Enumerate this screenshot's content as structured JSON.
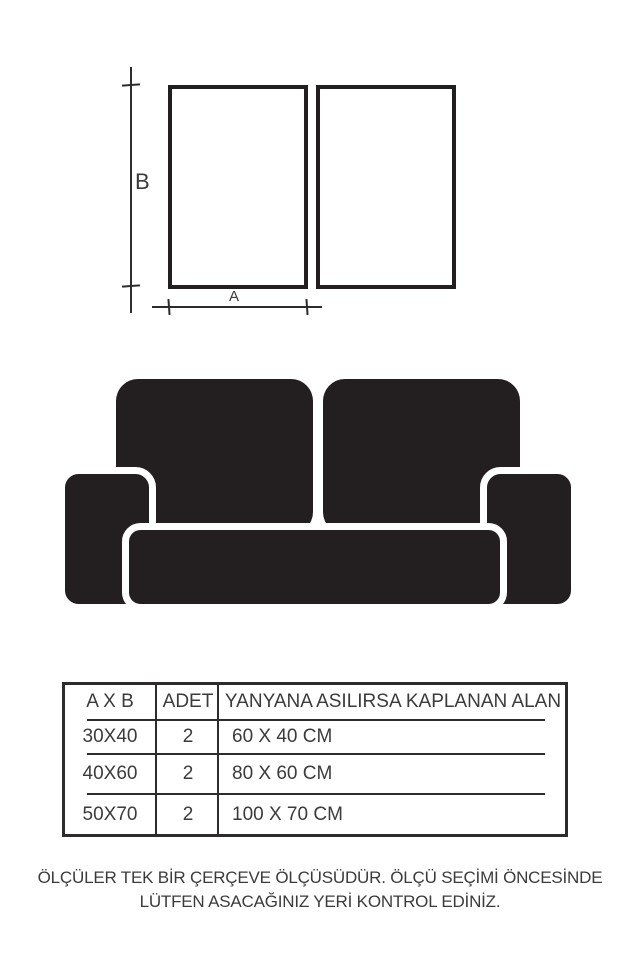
{
  "diagram": {
    "label_b": "B",
    "label_a": "A",
    "frame_count": 2
  },
  "table": {
    "headers": [
      "A X B",
      "ADET",
      "YANYANA ASILIRSA KAPLANAN ALAN"
    ],
    "rows": [
      [
        "30X40",
        "2",
        "60 X 40 CM"
      ],
      [
        "40X60",
        "2",
        "80 X 60 CM"
      ],
      [
        "50X70",
        "2",
        "100 X 70 CM"
      ]
    ]
  },
  "footer": {
    "line1": "ÖLÇÜLER TEK BİR ÇERÇEVE ÖLÇÜSÜDÜR. ÖLÇÜ SEÇİMİ ÖNCESİNDE",
    "line2": "LÜTFEN ASACAĞINIZ YERİ KONTROL EDİNİZ."
  },
  "colors": {
    "ink": "#231f20",
    "line": "#2e2b2c",
    "text": "#3d3a3b",
    "bg": "#ffffff"
  }
}
